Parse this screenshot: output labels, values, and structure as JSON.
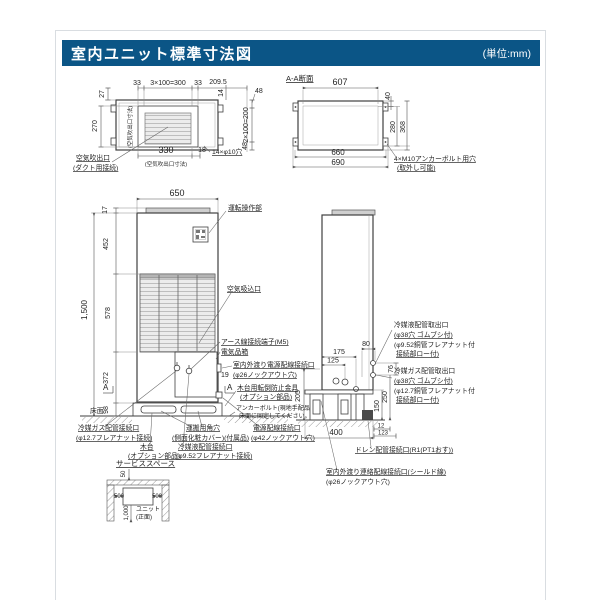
{
  "header": {
    "title": "室内ユニット標準寸法図",
    "unit_note": "(単位:mm)"
  },
  "colors": {
    "header_bg": "#0b5586",
    "line": "#3f3f3f",
    "fill_light": "#ececec"
  },
  "top_view": {
    "dim_33_left": "33",
    "dim_3x100": "3×100=300",
    "dim_33_right": "33",
    "dim_209_5": "209.5",
    "dim_14": "14",
    "dim_48_top": "48",
    "dim_2x100": "2×100=200",
    "dim_48_bottom": "48",
    "dim_27": "27",
    "dim_270": "270",
    "dim_330": "330",
    "dim_18": "18",
    "note_holes": "14×φ10穴",
    "label_outlet_line1": "空気吹出口",
    "label_outlet_line2": "(ダクト用接続)",
    "note_outlet_dim_bottom": "(空気吹出口寸法)",
    "note_outlet_dim_left": "(空気吹出口寸法)"
  },
  "section_view": {
    "title": "A-A断面",
    "dim_607": "607",
    "dim_40": "40",
    "dim_280": "280",
    "dim_368": "368",
    "dim_660": "660",
    "dim_690": "690",
    "label_anchor_line1": "4×M10アンカーボルト用穴",
    "label_anchor_line2": "(取外し可能)"
  },
  "front_view": {
    "dim_650": "650",
    "dim_17": "17",
    "dim_452": "452",
    "dim_1500": "1,500",
    "dim_578": "578",
    "dim_372": "372",
    "dim_98": "98",
    "dim_19": "19",
    "section_mark": "A",
    "label_control_panel": "運転操作部",
    "label_air_intake": "空気吸込口",
    "label_earth_terminal": "アース線接続端子(M5)",
    "label_electric_box": "電気品箱",
    "label_crossover_power_line1": "室内外渡り電源配線接続口",
    "label_crossover_power_line2": "(φ26ノックアウト穴)",
    "label_tip_guard_line1": "木台用転倒防止金具",
    "label_tip_guard_line2": "(オプション部品)",
    "note_anchor_line1": "アンカーボルト(現地手配品)で",
    "note_anchor_line2": "床面に固定してください。",
    "label_power_line1": "電源配線接続口",
    "label_power_line2": "(φ42ノックアウト穴)",
    "label_carry_hole_line1": "運搬用角穴",
    "label_carry_hole_line2": "(側面化粧カバー)(付属品)",
    "label_gas_pipe_line1": "冷媒ガス配管接続口",
    "label_gas_pipe_line2": "(φ12.7フレアナット接続)",
    "label_wood_base_line1": "木台",
    "label_wood_base_line2": "(オプション部品)",
    "label_liquid_pipe_line1": "冷媒液配管接続口",
    "label_liquid_pipe_line2": "(φ9.52フレアナット接続)",
    "label_floor": "床面"
  },
  "side_view": {
    "dim_175": "175",
    "dim_125": "125",
    "dim_80": "80",
    "dim_205": "205",
    "dim_76": "76",
    "dim_250": "250",
    "dim_150": "150",
    "dim_12": "12",
    "dim_123": "123",
    "dim_400": "400",
    "label_liquid_out_line1": "冷媒液配管取出口",
    "label_liquid_out_line2": "(φ38穴 ゴムブシ付)",
    "label_liquid_out_line3": "(φ9.52銅管フレアナット付",
    "label_liquid_out_line4": "接続部ロー付)",
    "label_gas_out_line1": "冷媒ガス配管取出口",
    "label_gas_out_line2": "(φ38穴 ゴムブシ付)",
    "label_gas_out_line3": "(φ12.7銅管フレアナット付",
    "label_gas_out_line4": "接続部ロー付)",
    "label_drain": "ドレン配管接続口(R1(PT1おす))",
    "label_signal_line1": "室内外渡り連絡配線接続口(シールド線)",
    "label_signal_line2": "(φ26ノックアウト穴)"
  },
  "service_space": {
    "title": "サービススペース",
    "dim_50": "50",
    "dim_500_left": "500",
    "dim_500_right": "500",
    "dim_1000": "1,000",
    "label_unit_line1": "ユニット",
    "label_unit_line2": "(正面)"
  }
}
